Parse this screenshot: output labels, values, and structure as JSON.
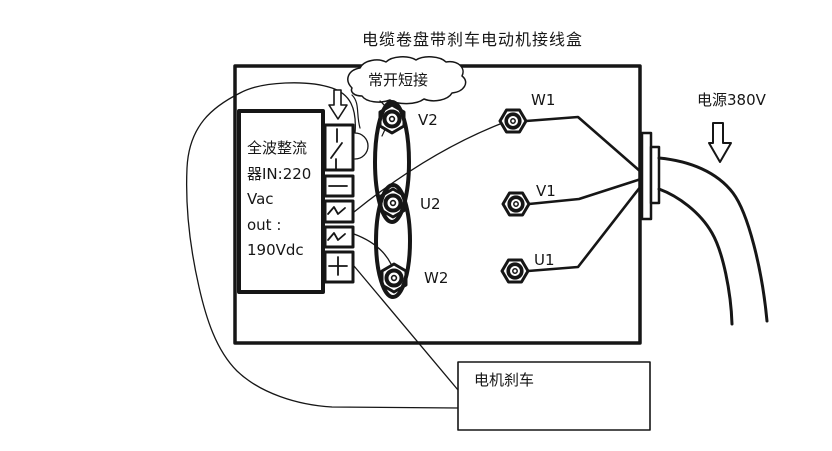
{
  "title": "电缆卷盘带刹车电动机接线盒",
  "junction_box": {
    "cloud_note": "常开短接",
    "rectifier_label": "全波整流\n器IN:220\nVac\nout :\n190Vdc",
    "left_terminals": [
      {
        "label": "V2"
      },
      {
        "label": "U2"
      },
      {
        "label": "W2"
      }
    ],
    "right_terminals": [
      {
        "label": "W1"
      },
      {
        "label": "V1"
      },
      {
        "label": "U1"
      }
    ],
    "terminal_strip_symbols": [
      "brake-switch",
      "minus",
      "ac-wave",
      "ac-wave",
      "plus"
    ]
  },
  "power_label": "电源380V",
  "brake_box_label": "电机刹车",
  "colors": {
    "line": "#161616",
    "background": "#ffffff"
  }
}
